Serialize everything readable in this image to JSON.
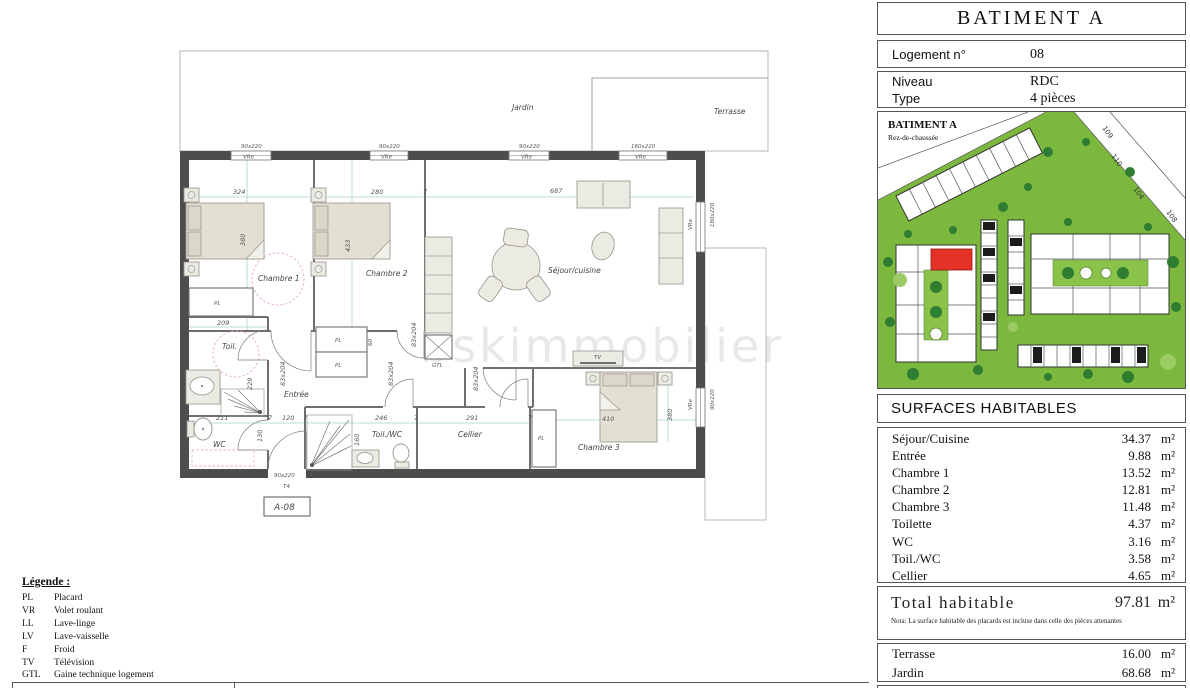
{
  "header": {
    "title": "BATIMENT A",
    "rows": [
      {
        "label": "Logement n°",
        "value": "08"
      },
      {
        "label": "Niveau",
        "value": "RDC"
      },
      {
        "label": "Type",
        "value": "4 pièces"
      }
    ]
  },
  "site_plan": {
    "title": "BATIMENT A",
    "subtitle": "Rez-de-chaussée",
    "plots": [
      "109",
      "110",
      "104",
      "108"
    ],
    "highlight_color": "#e53128",
    "grass_color": "#7cb83e"
  },
  "surfaces": {
    "title": "SURFACES HABITABLES",
    "unit": "m²",
    "rows": [
      {
        "label": "Séjour/Cuisine",
        "value": "34.37"
      },
      {
        "label": "Entrée",
        "value": "9.88"
      },
      {
        "label": "Chambre 1",
        "value": "13.52"
      },
      {
        "label": "Chambre 2",
        "value": "12.81"
      },
      {
        "label": "Chambre 3",
        "value": "11.48"
      },
      {
        "label": "Toilette",
        "value": "4.37"
      },
      {
        "label": "WC",
        "value": "3.16"
      },
      {
        "label": "Toil./WC",
        "value": "3.58"
      },
      {
        "label": "Cellier",
        "value": "4.65"
      }
    ]
  },
  "total": {
    "label": "Total habitable",
    "value": "97.81",
    "unit": "m²",
    "nota": "Nota: La surface habitable des placards est incluse dans celle des pièces attenantes"
  },
  "exterior": {
    "unit": "m²",
    "rows": [
      {
        "label": "Terrasse",
        "value": "16.00"
      },
      {
        "label": "Jardin",
        "value": "68.68"
      }
    ]
  },
  "legend": {
    "title": "Légende :",
    "items": [
      {
        "abbr": "PL",
        "label": "Placard"
      },
      {
        "abbr": "VR",
        "label": "Volet roulant"
      },
      {
        "abbr": "LL",
        "label": "Lave-linge"
      },
      {
        "abbr": "LV",
        "label": "Lave-vaisselle"
      },
      {
        "abbr": "F",
        "label": "Froid"
      },
      {
        "abbr": "TV",
        "label": "Télévision"
      },
      {
        "abbr": "GTL",
        "label": "Gaine technique logement"
      }
    ]
  },
  "plan": {
    "unit_ref": "A-08",
    "watermark": "bskimmobilier",
    "rooms": {
      "jardin": "Jardin",
      "terrasse": "Terrasse",
      "chambre1": "Chambre 1",
      "chambre2": "Chambre 2",
      "chambre3": "Chambre 3",
      "sejour": "Séjour/cuisine",
      "entree": "Entrée",
      "toil": "Toil.",
      "wc": "WC",
      "toilwc": "Toil./WC",
      "cellier": "Cellier"
    },
    "labels": {
      "pl": "PL",
      "gtl": "GTL",
      "tv": "TV",
      "vre": "VRe",
      "t4": "T4",
      "door": "83x204",
      "win90": "90x220",
      "win160": "160x220",
      "win180": "180x220"
    },
    "dims": {
      "d324": "324",
      "d280": "280",
      "d687": "687",
      "d380": "380",
      "d433": "433",
      "d209": "209",
      "d229": "229",
      "d211": "211",
      "d120": "120",
      "d246": "246",
      "d291": "291",
      "d410": "410",
      "d160": "160",
      "d130": "130",
      "d60": "60",
      "d7": "7"
    }
  }
}
